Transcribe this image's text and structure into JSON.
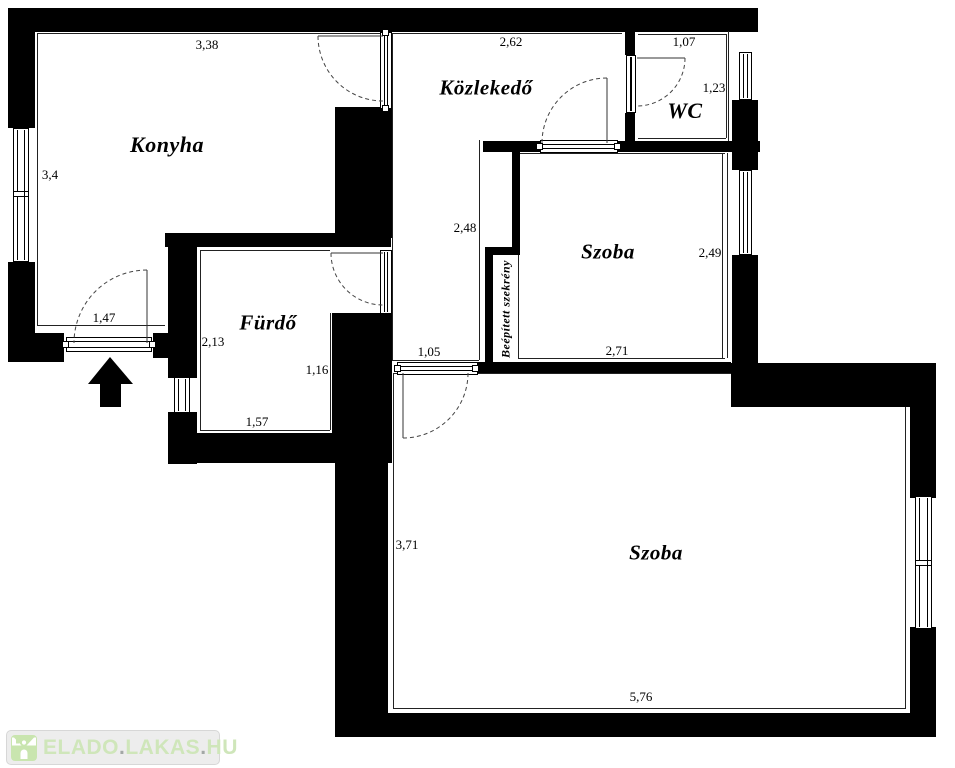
{
  "rooms": {
    "konyha": {
      "label": "Konyha"
    },
    "kozlekedo": {
      "label": "Közlekedő"
    },
    "wc": {
      "label": "WC"
    },
    "furdo": {
      "label": "Fürdő"
    },
    "szoba1": {
      "label": "Szoba"
    },
    "szoba2": {
      "label": "Szoba"
    },
    "szekreny": {
      "label": "Beépített szekrény"
    }
  },
  "dimensions": {
    "konyha_w": "3,38",
    "konyha_h": "3,4",
    "entrance_w": "1,47",
    "kozlekedo_w": "2,62",
    "kozlekedo_h": "2,48",
    "kozlekedo_door_w": "1,05",
    "wc_w": "1,07",
    "wc_h": "1,23",
    "szoba1_h": "2,49",
    "szoba1_w": "2,71",
    "furdo_h": "2,13",
    "furdo_inner_h": "1,16",
    "furdo_w": "1,57",
    "szoba2_h": "3,71",
    "szoba2_w": "5,76"
  },
  "watermark": {
    "word1": "ELADO",
    "dot1": ".",
    "word2": "LAKAS",
    "dot2": ".",
    "word3": "HU"
  },
  "colors": {
    "wall": "#000000",
    "line": "#222222",
    "watermark_green": "#cfe6ba",
    "watermark_icon_green": "#c9e5af",
    "watermark_dot_gray": "#a3a8a6",
    "badge_bg": "#ededed"
  }
}
